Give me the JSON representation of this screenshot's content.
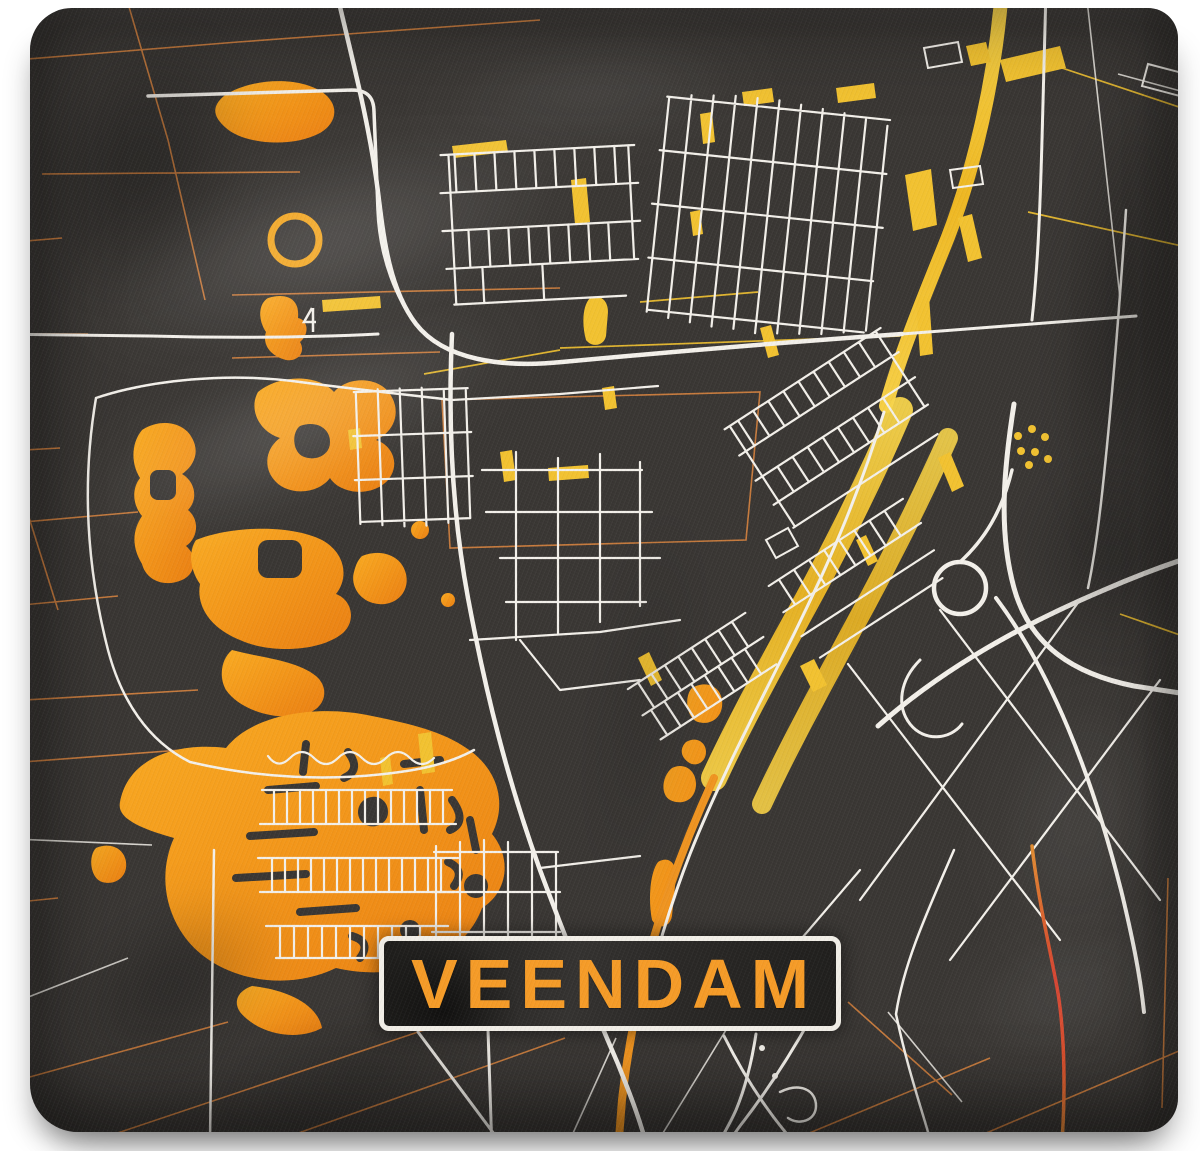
{
  "plate": {
    "text": "VEENDAM"
  },
  "colors": {
    "page_bg": "#ffffff",
    "fabric": "#393633",
    "fabric_dark": "#23211e",
    "road_white": "#f3f0ea",
    "accent_orange": "#f59b27",
    "water_orange": "#f6a01f",
    "water_orange_deep": "#ec8414",
    "gold": "#f2c230",
    "boundary_orange": "#cd7e3e",
    "red_road": "#d63c2a",
    "plate_border": "#f1eee7",
    "plate_bg": "#272523"
  }
}
